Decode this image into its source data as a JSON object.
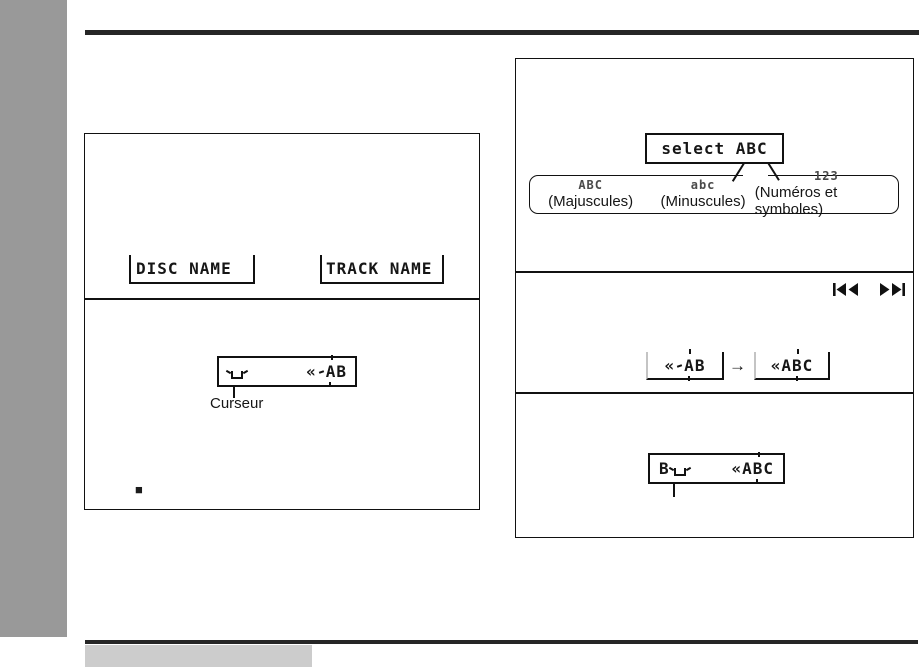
{
  "page": {
    "colors": {
      "sidebar": "#999999",
      "rule": "#262626",
      "footer_box": "#cccccc",
      "ink": "#111111"
    }
  },
  "left_panel": {
    "name_displays": {
      "disc": "DISC NAME",
      "track": "TRACK NAME"
    },
    "cursor_display": {
      "prefix": "«",
      "blink_char": "A",
      "suffix": "B"
    },
    "cursor_label": "Curseur",
    "bullet": "■"
  },
  "right_panel": {
    "select_display": "select ABC",
    "charset_row": [
      {
        "lcd": "ABC",
        "label": "(Majuscules)"
      },
      {
        "lcd": "abc",
        "label": "(Minuscules)"
      },
      {
        "lcd": "123",
        "label": "(Numéros et symboles)"
      }
    ],
    "sequence": {
      "before": {
        "prefix": "«",
        "blink_char": "A",
        "suffix": "B"
      },
      "arrow": "→",
      "after": {
        "prefix": "«A",
        "blink_char": "B",
        "suffix": "C"
      }
    },
    "final_display": {
      "typed": "B",
      "prefix": "«A",
      "blink_char": "B",
      "suffix": "C"
    }
  }
}
